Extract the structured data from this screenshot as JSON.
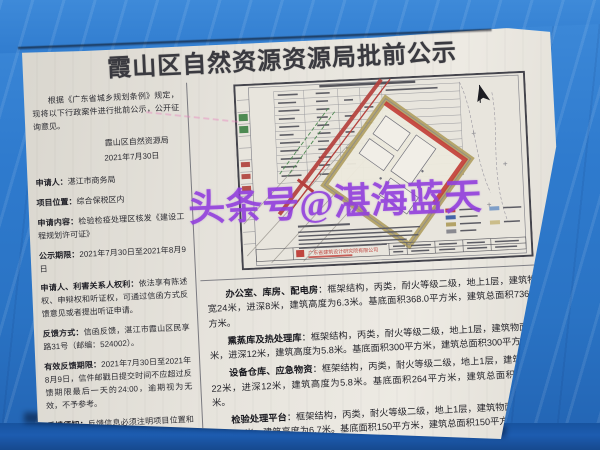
{
  "photo": {
    "watermark_text": "头条号@湛海蓝天",
    "watermark_color": "#9240dc"
  },
  "notice": {
    "title": "霞山区自然资源资源局批前公示",
    "intro": "根据《广东省城乡规划条例》规定，现将以下行政案件进行批前公示，公开征询意见。",
    "issuer": "霞山区自然资源局",
    "date": "2021年7月30日",
    "fields": [
      {
        "label": "申请人：",
        "text": "湛江市商务局"
      },
      {
        "label": "项目位置：",
        "text": "综合保税区内"
      },
      {
        "label": "申请内容：",
        "text": "检验检疫处理区核发《建设工程规划许可证》"
      },
      {
        "label": "公示期限：",
        "text": "2021年7月30日至2021年8月9日"
      },
      {
        "label": "申请人、利害关系人权利：",
        "text": "依法享有陈述权、申辩权和听证权，可通过信函方式反馈意见或者提出听证申请。"
      },
      {
        "label": "反馈方式：",
        "text": "信函反馈，湛江市霞山区民享路31号（邮编：524002）。"
      },
      {
        "label": "有效反馈期限：",
        "text": "2021年7月30日至2021年8月9日，信件邮戳日提交时间不应超过反馈期限最后一天的24:00，逾期视为无效，不予参考。"
      },
      {
        "label": "反馈须知：",
        "text": "反馈信息必须注明项目位置和真实姓名、联系电话、联系地址、邮政编码。如反馈信息不准确或不完整，导致无法核实有关情况的视为无效。"
      }
    ]
  },
  "buildings": [
    {
      "name": "办公室、库房、配电房",
      "body": "：框架结构，丙类，耐火等级二级，地上1层，建筑物面宽24米，进深8米，建筑高度为6.3米。基底面积368.0平方米，建筑总面积736.0平方米。"
    },
    {
      "name": "熏蒸库及热处理库",
      "body": "：框架结构，丙类，耐火等级二级，地上1层，建筑物面宽25米，进深12米，建筑高度为5.8米。基底面积300平方米，建筑总面积300平方米。"
    },
    {
      "name": "设备仓库、应急物资",
      "body": "：框架结构，丙类，耐火等级二级，地上1层，建筑物面宽22米，进深12米，建筑高度为5.8米。基底面积264平方米，建筑总面积264平方米。"
    },
    {
      "name": "检验处理平台",
      "body": "：框架结构，丙类，耐火等级二级，地上1层，建筑物面宽25米，进深7.8米，建筑高度为6.7米。基底面积150平方米，建筑总面积150平方米。"
    }
  ],
  "drawing": {
    "company": "广东省建筑设计研究院有限公司"
  },
  "colors": {
    "tarp_blue": "#2c78cc",
    "paper": "#e6e3db",
    "red_accent": "#b5403c",
    "khaki_site": "#b3a266"
  }
}
